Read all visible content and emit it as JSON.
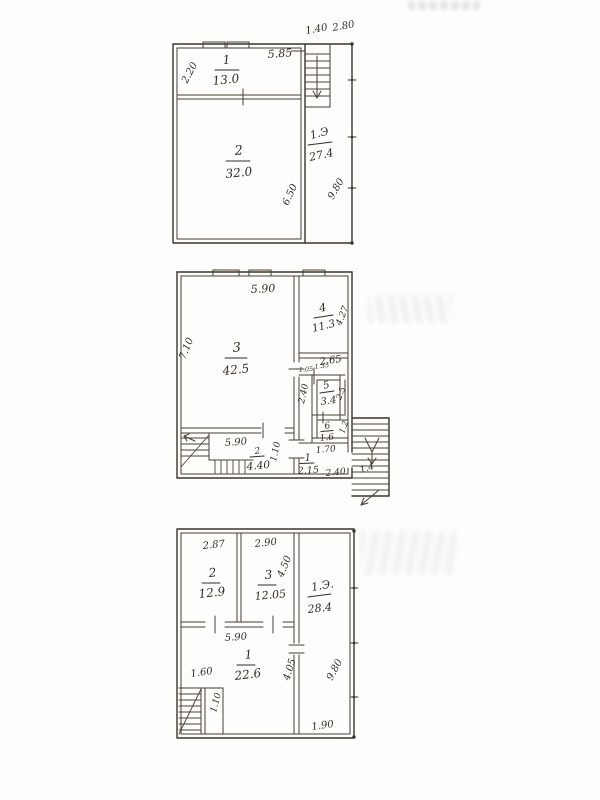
{
  "page": {
    "paper_color": "#fdfdfb",
    "ink_color": "#3b352b"
  },
  "plans": {
    "top": {
      "rooms": [
        {
          "number": "1",
          "area": "13.0"
        },
        {
          "number": "2",
          "area": "32.0"
        }
      ],
      "porch": {
        "label": "1.Э",
        "area": "27.4"
      },
      "dims": {
        "room1_width": "5.85",
        "room1_depth": "2.20",
        "stair_width": "1.40",
        "porch_width": "2.80",
        "room2_depth": "6.50",
        "side_height": "9.80"
      }
    },
    "middle": {
      "rooms": [
        {
          "number": "3",
          "area": "42.5"
        },
        {
          "number": "4",
          "area": "11.3"
        },
        {
          "number": "5",
          "area": "3.4"
        },
        {
          "number": "6",
          "area": "1.6"
        },
        {
          "number": "1",
          "area": "2.15"
        },
        {
          "number": "2",
          "area": "4.40"
        }
      ],
      "dims": {
        "room3_width": "5.90",
        "room3_depth": "7.10",
        "room4_width": "2.65",
        "room4_depth": "4.27",
        "door_left": "1.05",
        "door_right": "1.35",
        "duct_height": "2.40",
        "room5_depth": "2.5",
        "room6_depth": "1.2",
        "hall_width": "1.70",
        "stairhall_width": "5.90",
        "stairhall_depth": "1.10",
        "bottom_dim": "2.40",
        "outer_stair_width": "1.4"
      }
    },
    "bottom": {
      "rooms": [
        {
          "number": "2",
          "area": "12.9"
        },
        {
          "number": "3",
          "area": "12.05"
        },
        {
          "number": "1",
          "area": "22.6"
        }
      ],
      "porch": {
        "label": "1.Э.",
        "area": "28.4"
      },
      "dims": {
        "room2_width": "2.87",
        "room3_width": "2.90",
        "room3_depth": "4.50",
        "room1_width": "5.90",
        "stair_width": "1.60",
        "closet_depth": "1.10",
        "room1_depth": "4.05",
        "side_height": "9.80",
        "bottom_width": "1.90"
      }
    }
  }
}
